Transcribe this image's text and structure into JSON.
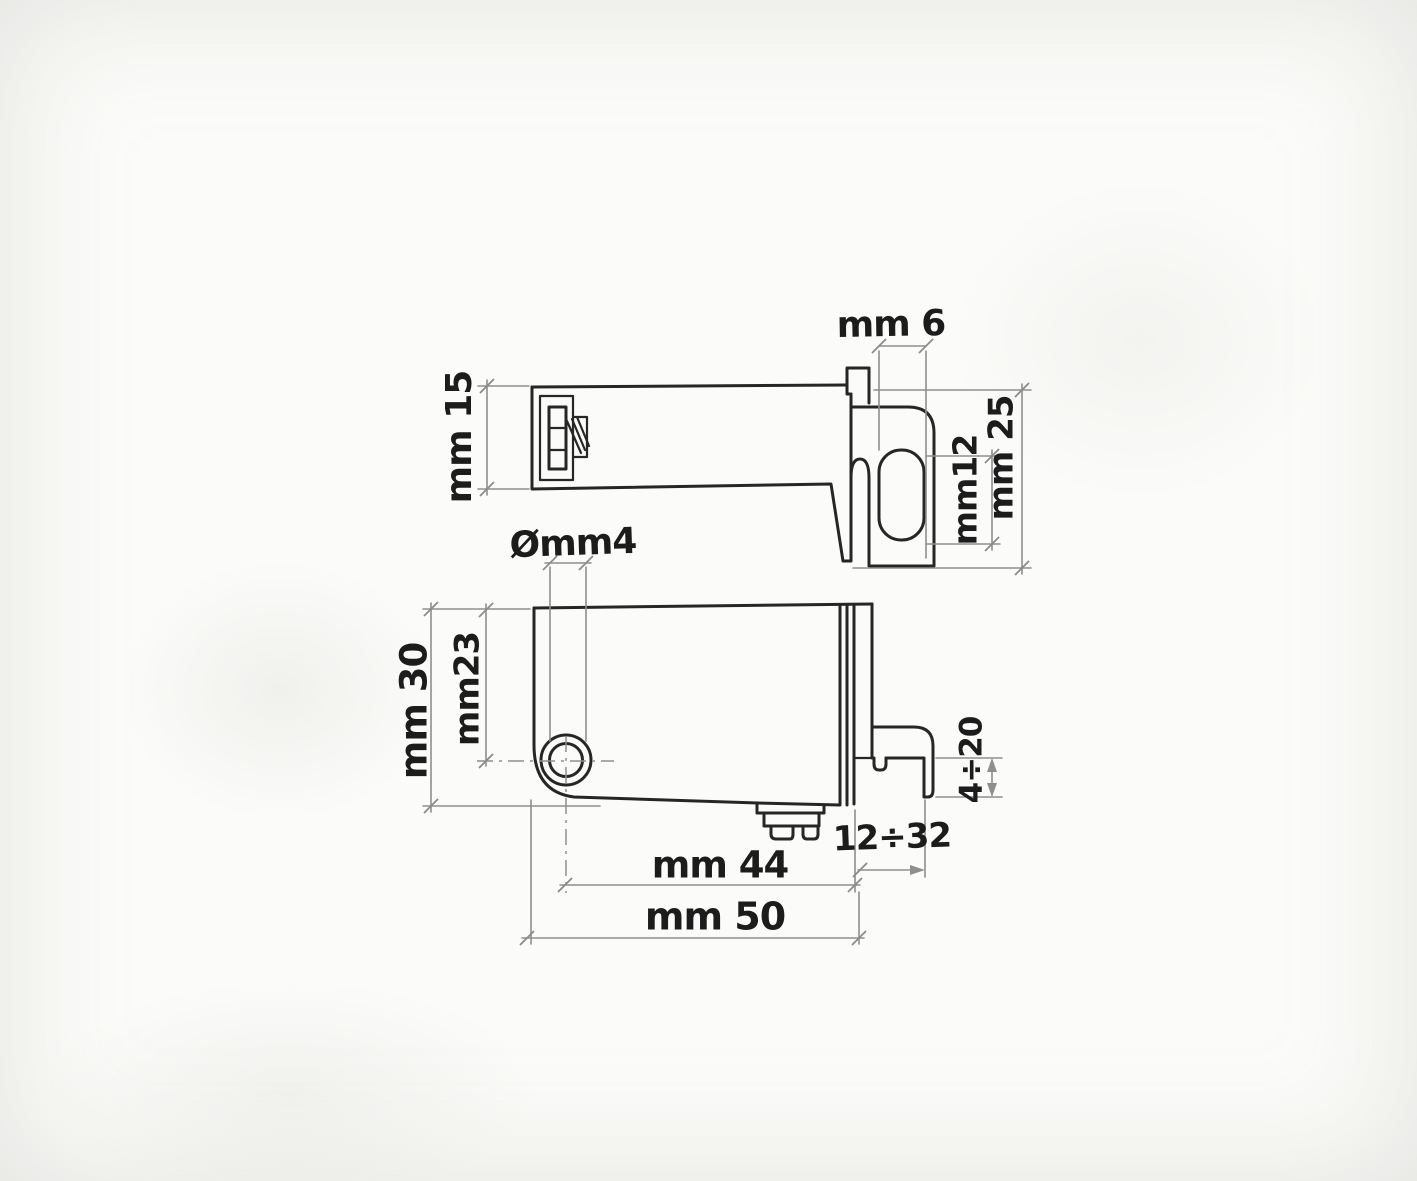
{
  "drawing": {
    "kind": "hand-drawn technical sketch, two orthographic views of a mounting bracket",
    "unit": "mm",
    "colors": {
      "ink": "#262626",
      "dimension_lines": "#8f8f8f",
      "paper": "#fbfbf9"
    },
    "top_view": {
      "body_height_label": "mm 15",
      "slot_width_label": "mm 6",
      "slot_length_label": "mm12",
      "bracket_height_label": "mm 25"
    },
    "side_view": {
      "hole_diameter_label": "Ømm4",
      "total_height_label": "mm 30",
      "hole_center_height_label": "mm23",
      "hole_to_end_label": "mm 44",
      "total_length_label": "mm 50",
      "bracket_travel_label": "12÷32",
      "leg_travel_label": "4÷20"
    }
  }
}
